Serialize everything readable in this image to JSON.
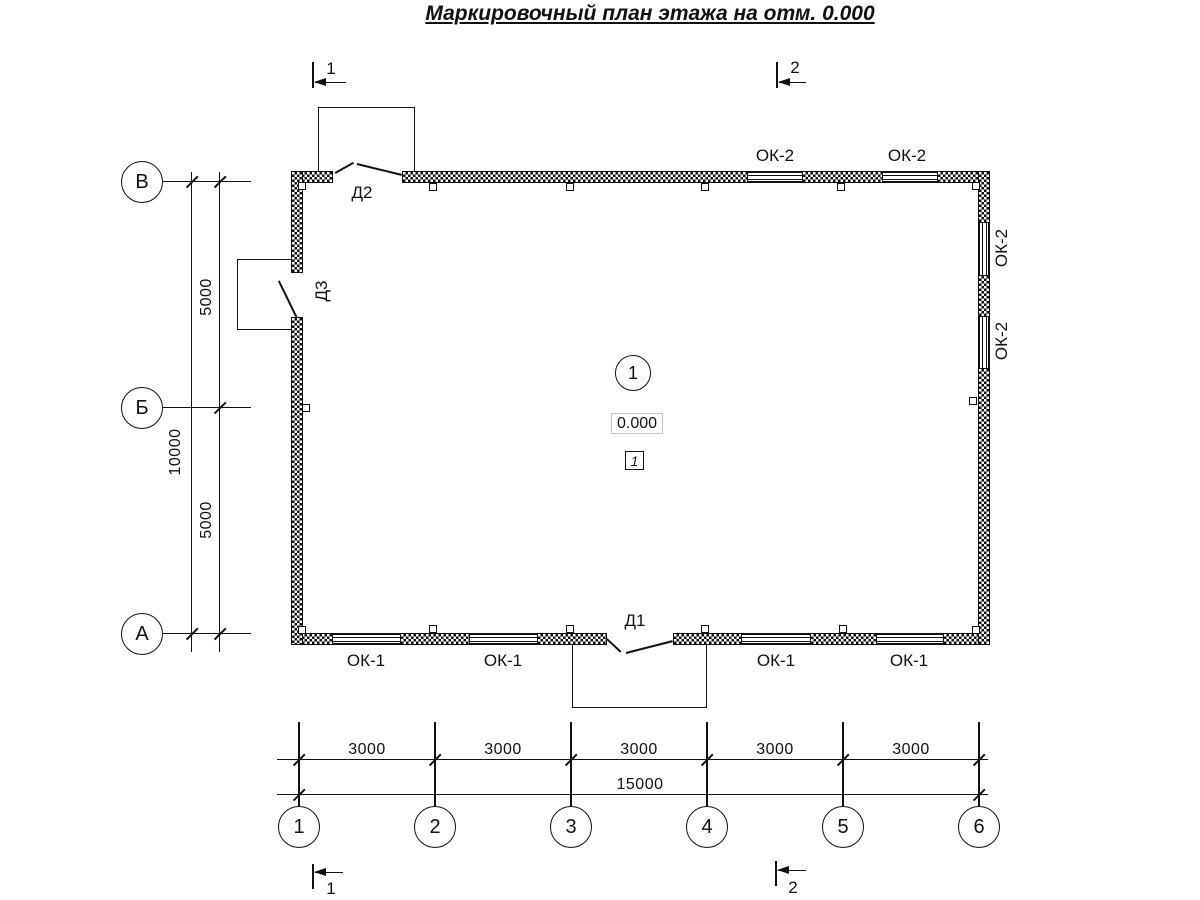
{
  "title": "Маркировочный план этажа на отм. 0.000",
  "axes": {
    "rows": [
      "В",
      "Б",
      "А"
    ],
    "cols": [
      "1",
      "2",
      "3",
      "4",
      "5",
      "6"
    ]
  },
  "dims": {
    "row_spans": [
      "5000",
      "5000"
    ],
    "row_total": "10000",
    "col_spans": [
      "3000",
      "3000",
      "3000",
      "3000",
      "3000"
    ],
    "col_total": "15000"
  },
  "sections": {
    "one": "1",
    "two": "2"
  },
  "doors": {
    "d1": "Д1",
    "d2": "Д2",
    "d3": "Д3"
  },
  "windows": {
    "bottom": [
      "ОК-1",
      "ОК-1",
      "ОК-1",
      "ОК-1"
    ],
    "top": [
      "ОК-2",
      "ОК-2"
    ],
    "right": [
      "ОК-2",
      "ОК-2"
    ]
  },
  "room": {
    "number": "1",
    "elevation": "0.000",
    "type_mark": "1"
  }
}
